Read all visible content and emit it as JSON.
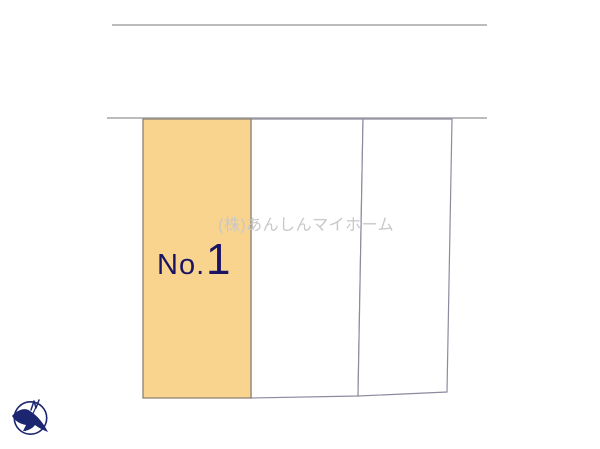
{
  "plan": {
    "watermark_text": "(株)あんしんマイホーム",
    "highlight_lot": {
      "label_prefix": "No.",
      "label_number": "1"
    },
    "icons": {
      "compass": "north-compass-icon"
    },
    "colors": {
      "background": "#FFFFFF",
      "highlight_fill": "#F8D48E",
      "highlight_border": "#8D8173",
      "parcel_fill": "#FFFFFF",
      "parcel_border": "#8B8B9E",
      "road_line": "#A5A5AA",
      "lot_label": "#1B1464",
      "watermark": "#C8C8C8",
      "compass": "#1B2570"
    }
  }
}
